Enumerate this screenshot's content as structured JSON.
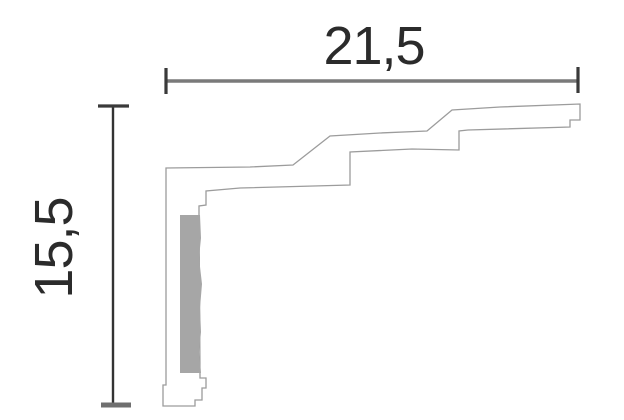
{
  "diagram": {
    "type": "moulding-profile-cross-section",
    "dimensions": {
      "width_label": "21,5",
      "height_label": "15,5"
    },
    "colors": {
      "background": "#ffffff",
      "outline": "#9c9c9c",
      "dimension_line_horizontal": "#7a7a7a",
      "dimension_line_vertical": "#333333",
      "tick_dark": "#3a3a3a",
      "tick_gray": "#6f6f6f",
      "label_text": "#2b2b2b",
      "adhesive_strip": "#a6a6a6"
    }
  }
}
